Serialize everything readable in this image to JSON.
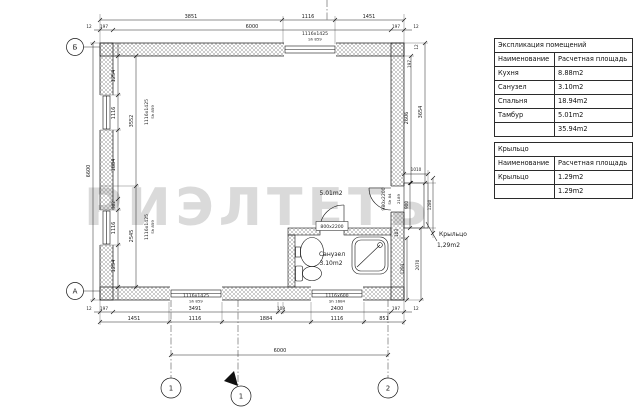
{
  "watermark": {
    "text": "РИЭЛТЕТЬ"
  },
  "tables": {
    "explication": {
      "title": "Экспликация помещений",
      "columns": [
        "Наименование",
        "Расчетная площадь"
      ],
      "rows": [
        {
          "name": "Кухня",
          "area": "8.88m2"
        },
        {
          "name": "Санузел",
          "area": "3.10m2"
        },
        {
          "name": "Спальня",
          "area": "18.94m2"
        },
        {
          "name": "Тамбур",
          "area": "5.01m2"
        }
      ],
      "total": {
        "name": "",
        "area": "35.94m2"
      }
    },
    "porch": {
      "title": "Крыльцо",
      "columns": [
        "Наименование",
        "Расчетная площадь"
      ],
      "rows": [
        {
          "name": "Крыльцо",
          "area": "1.29m2"
        }
      ],
      "total": {
        "name": "",
        "area": "1.29m2"
      }
    }
  },
  "plan": {
    "axes": {
      "top_left": "Б",
      "bottom_left": "А",
      "col_1": "1",
      "col_2": "2",
      "section": "1"
    },
    "rooms": {
      "bathroom": {
        "name": "Санузел",
        "area": "3.10m2"
      },
      "tambour_area": "5.01m2",
      "porch": {
        "name": "Крыльцо",
        "area": "1,29m2"
      }
    },
    "openings": {
      "window_top": {
        "size": "1116x1425",
        "sill": "Sh 859"
      },
      "window_left_upper": {
        "size": "1116x1425",
        "sill": "Sh 859"
      },
      "window_left_lower": {
        "size": "1116x1425",
        "sill": "Sh 859"
      },
      "window_bottom_left": {
        "size": "1116x1425",
        "sill": "Sh 859"
      },
      "window_bottom_right": {
        "size": "1116x600",
        "sill": "Sh 1684"
      },
      "door_bathroom": {
        "size": "800x2200"
      },
      "door_entry": {
        "size": "980x2200",
        "sill": "Sh 84",
        "offset": "2189"
      }
    },
    "dims": {
      "top_row1": [
        "3851",
        "1116",
        "1451"
      ],
      "top_row2": [
        "12",
        "197",
        "6000",
        "197",
        "12"
      ],
      "bottom_row1": [
        "12",
        "197",
        "3491",
        "109",
        "2400",
        "197",
        "12"
      ],
      "bottom_row2": [
        "1451",
        "1116",
        "1884",
        "1116",
        "851"
      ],
      "bottom_total": "6000",
      "left_total": "6600",
      "left_chain": [
        "1254",
        "1116",
        "1884",
        "302",
        "1116",
        "1254"
      ],
      "left_tier": [
        "3552",
        "2545"
      ],
      "right_upper_outer": "3654",
      "right_upper_inner": "2606",
      "right_corner": [
        "12",
        "197"
      ],
      "porch_width": "1010",
      "porch_height": "900",
      "porch_outer": "1280",
      "right_small": "103",
      "right_lower_outer": "2070",
      "right_lower_inner": "1293"
    }
  }
}
